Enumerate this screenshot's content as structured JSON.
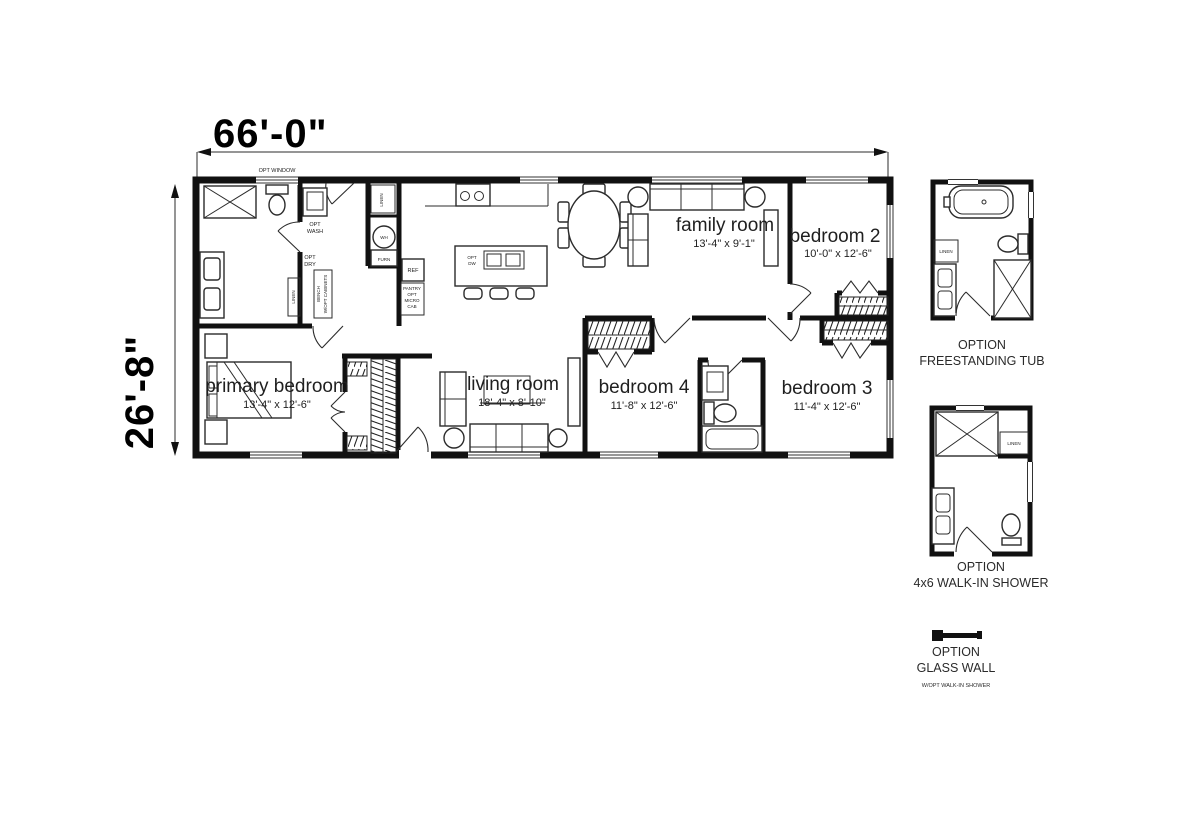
{
  "dimensions": {
    "width": "66'-0\"",
    "height": "26'-8\""
  },
  "rooms": {
    "family_room": {
      "name": "family room",
      "size": "13'-4\" x 9'-1\""
    },
    "bedroom_2": {
      "name": "bedroom 2",
      "size": "10'-0\" x 12'-6\""
    },
    "primary_bedroom": {
      "name": "primary bedroom",
      "size": "13'-4\" x 12'-6\""
    },
    "living_room": {
      "name": "living room",
      "size": "18'-4\" x 8'-10\""
    },
    "bedroom_4": {
      "name": "bedroom 4",
      "size": "11'-8\" x 12'-6\""
    },
    "bedroom_3": {
      "name": "bedroom 3",
      "size": "11'-4\" x 12'-6\""
    }
  },
  "labels": {
    "opt_window": "OPT WINDOW",
    "opt_wash": [
      "OPT",
      "WASH"
    ],
    "opt_dry": [
      "OPT",
      "DRY"
    ],
    "linen": "LINEN",
    "wh": "WH",
    "furn": "FURN",
    "ref": "REF",
    "pantry": [
      "PANTRY",
      "OPT",
      "MICRO",
      "CAB"
    ],
    "opt_dw": [
      "OPT",
      "DW"
    ],
    "bench": [
      "BENCH",
      "W/OPT CABINETS"
    ]
  },
  "options": {
    "freestanding_tub": {
      "line1": "OPTION",
      "line2": "FREESTANDING TUB"
    },
    "walk_in_shower": {
      "line1": "OPTION",
      "line2": "4x6 WALK-IN SHOWER"
    },
    "glass_wall": {
      "line1": "OPTION",
      "line2": "GLASS WALL",
      "subtext": "W/OPT WALK-IN SHOWER"
    }
  },
  "colors": {
    "background": "#ffffff",
    "wall": "#111111",
    "line": "#2b2b2b"
  }
}
